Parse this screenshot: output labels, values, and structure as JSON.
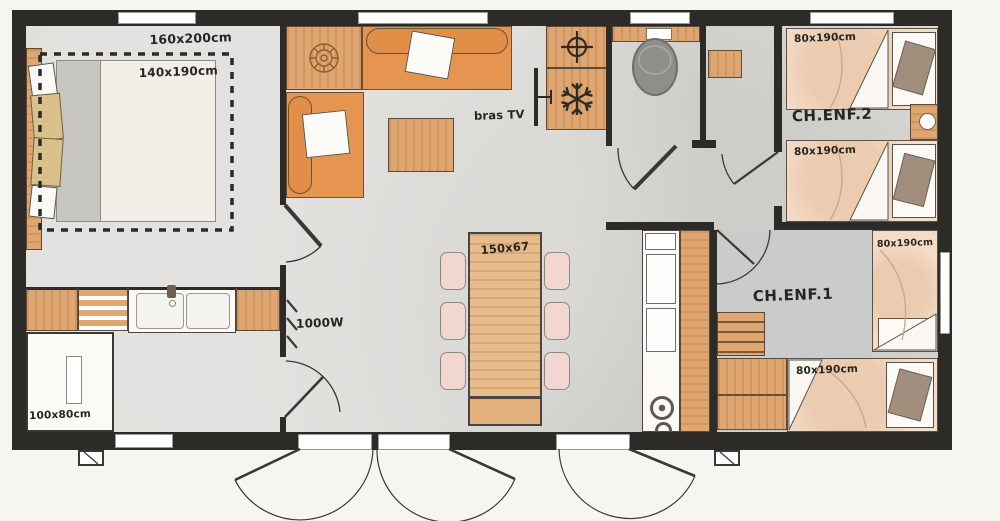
{
  "plan": {
    "master_bedroom": {
      "zone_dim": "160x200cm",
      "bed_dim": "140x190cm"
    },
    "living": {
      "tv_label": "bras TV"
    },
    "dining": {
      "table_dim": "150x67"
    },
    "hall": {
      "heater_power": "1000W"
    },
    "bathroom": {
      "shower_dim": "100x80cm"
    },
    "kids_room_2": {
      "name": "CH.ENF.2",
      "bed_top_dim": "80x190cm",
      "bed_bottom_dim": "80x190cm"
    },
    "kids_room_1": {
      "name": "CH.ENF.1",
      "bed_right_dim": "80x190cm",
      "bed_bottom_dim": "80x190cm"
    }
  },
  "icons": {
    "fridge": "snowflake-icon",
    "water_heater": "crosshair-icon",
    "decor_table": "rose-icon",
    "tv_mount": "tv-bracket-icon",
    "electric_heater": "heater-ticks-icon",
    "bedside_lamp": "lamp-circle-icon",
    "toilet": "toilet-oval-icon",
    "hob": "burner-rings-icon"
  },
  "colors": {
    "wall": "#2d2b27",
    "floor": "#dad9d5",
    "kids1_floor": "#c9cccb",
    "wood": "#e0a671",
    "sofa_orange": "#e5954f",
    "bed_peach": "#f4dcc7",
    "pillow_taupe": "#a28e7d",
    "pillow_khaki": "#d9c189",
    "toilet_gray": "#8e8e8b",
    "chair_pink": "#f1d7cf",
    "white": "#fbfaf7"
  }
}
